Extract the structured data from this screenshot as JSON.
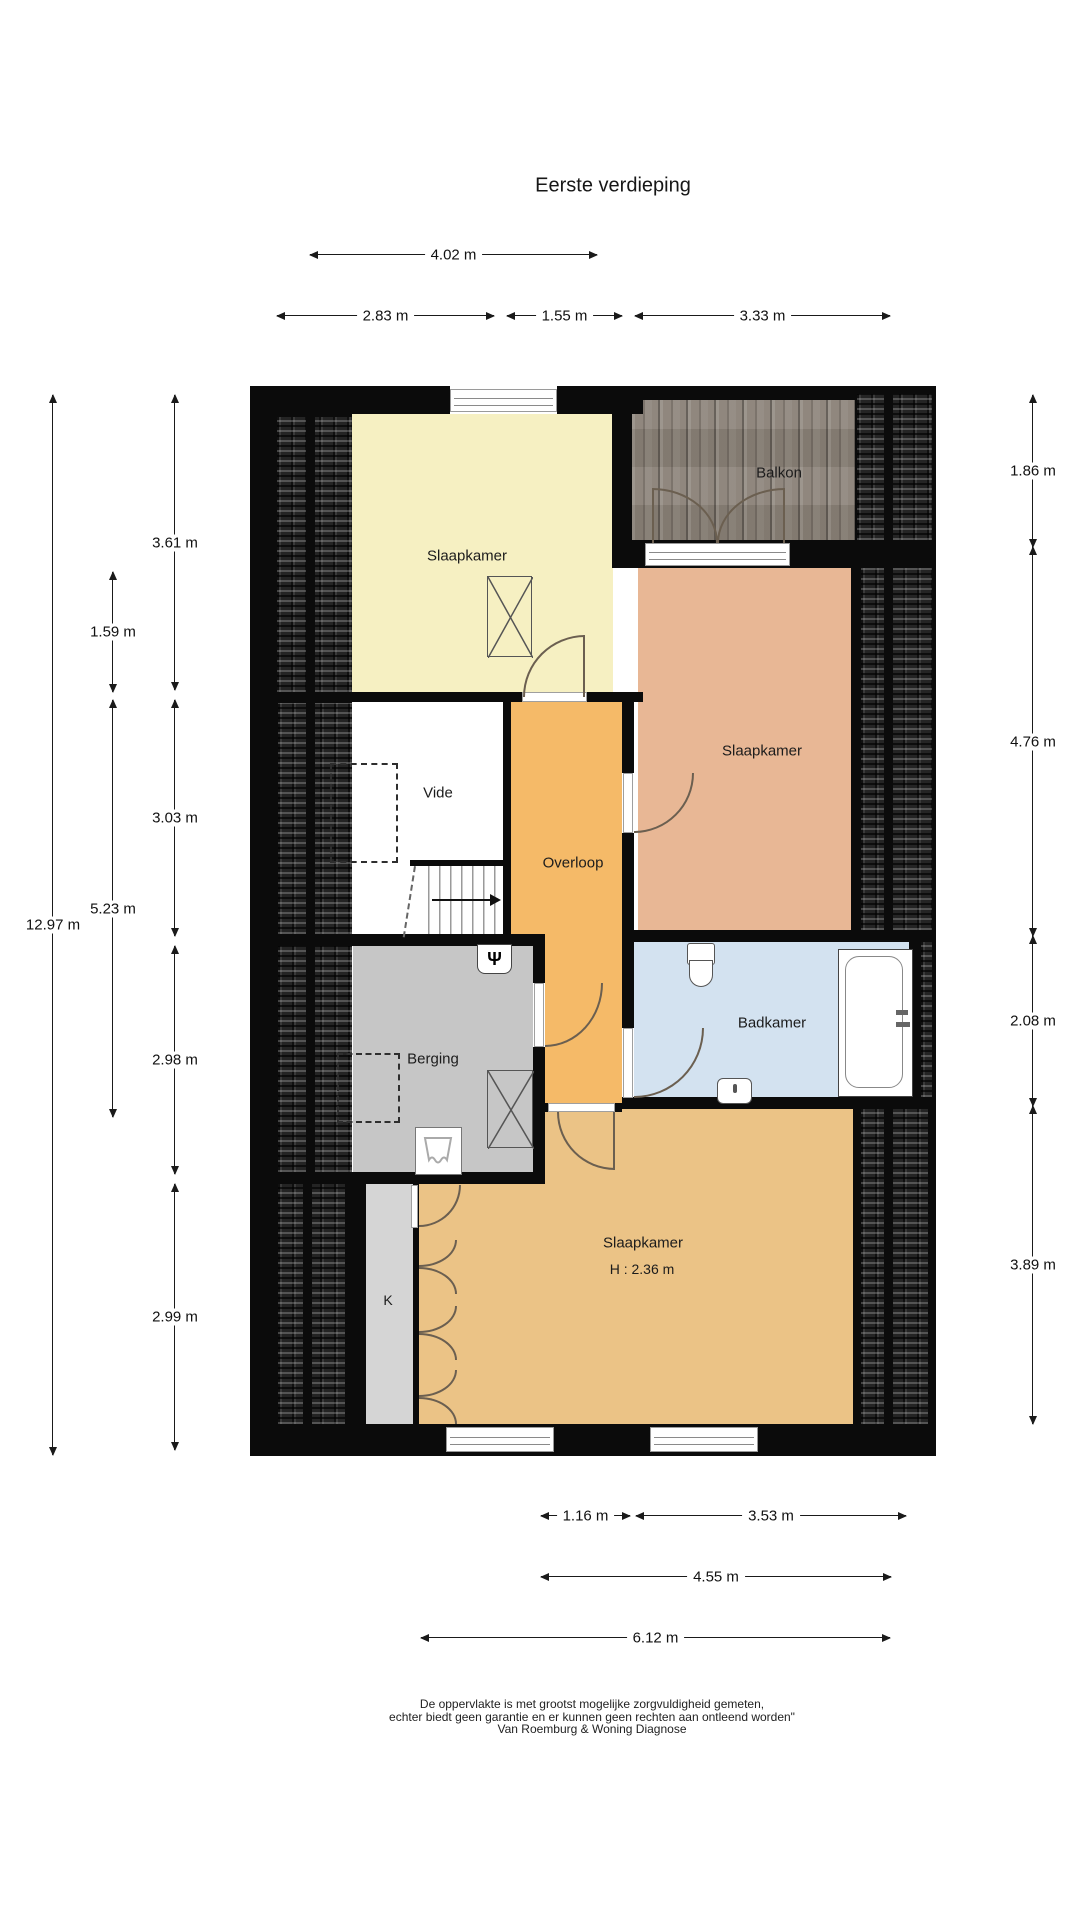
{
  "title": "Eerste verdieping",
  "rooms": {
    "slaapkamer_top": "Slaapkamer",
    "balkon": "Balkon",
    "slaapkamer_right": "Slaapkamer",
    "vide": "Vide",
    "overloop": "Overloop",
    "berging": "Berging",
    "badkamer": "Badkamer",
    "slaapkamer_bottom": "Slaapkamer",
    "slaapkamer_bottom_height": "H : 2.36 m",
    "kast": "K"
  },
  "dims": {
    "w402": "4.02 m",
    "w283": "2.83 m",
    "w155": "1.55 m",
    "w333": "3.33 m",
    "h1297": "12.97 m",
    "h159": "1.59 m",
    "h523": "5.23 m",
    "h361": "3.61 m",
    "h303": "3.03 m",
    "h298": "2.98 m",
    "h299": "2.99 m",
    "h186": "1.86 m",
    "h476": "4.76 m",
    "h208": "2.08 m",
    "h389": "3.89 m",
    "w116": "1.16 m",
    "w353": "3.53 m",
    "w455": "4.55 m",
    "w612": "6.12 m"
  },
  "footer": {
    "line1": "De oppervlakte is met grootst mogelijke zorgvuldigheid gemeten,",
    "line2": "echter biedt geen garantie en er kunnen geen rechten aan ontleend worden\"",
    "line3": "Van Roemburg & Woning Diagnose"
  },
  "icons": {
    "ventilation": "Ψ"
  },
  "colors": {
    "wall": "#0b0b0b",
    "bedroom_yellow": "#f6f0c2",
    "bedroom_salmon": "#e8b795",
    "bedroom_tan": "#ebc386",
    "overloop_orange": "#f5ba68",
    "badkamer_blue": "#d3e2f0",
    "berging_gray": "#c6c6c6",
    "k_gray": "#d5d5d5",
    "roof_dark": "#242424",
    "balcony_wood": "#8a8177"
  }
}
